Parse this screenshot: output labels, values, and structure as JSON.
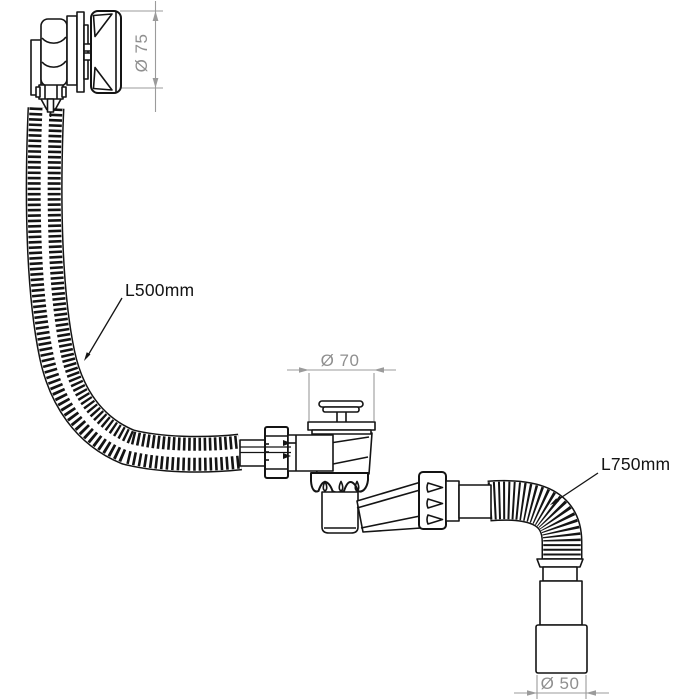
{
  "page": {
    "background_color": "#ffffff",
    "width": 700,
    "height": 700
  },
  "drawing": {
    "line_color": "#141414",
    "dimension_color": "#969696",
    "dimensions": [
      {
        "part": "overflow-cap",
        "label": "Ø 75"
      },
      {
        "part": "waste-plug-flange",
        "label": "Ø 70"
      },
      {
        "part": "outlet-connector",
        "label": "Ø 50"
      }
    ],
    "hose_labels": [
      {
        "part": "overflow-hose",
        "label": "L500mm"
      },
      {
        "part": "outlet-hose",
        "label": "L750mm"
      }
    ]
  }
}
